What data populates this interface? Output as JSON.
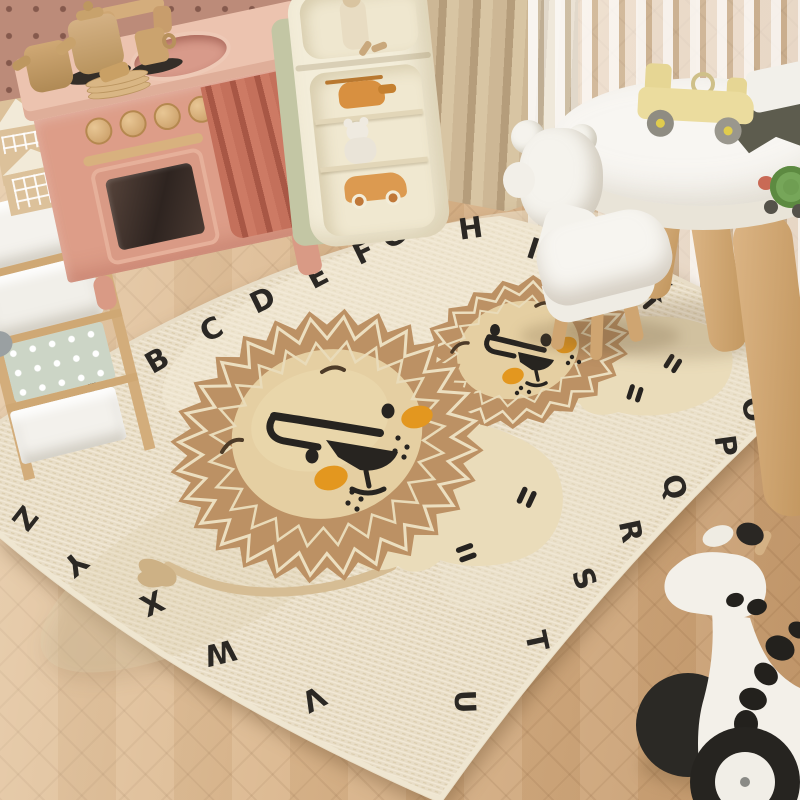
{
  "scene": {
    "setting": "children's playroom with alphabet lion rug"
  },
  "rug": {
    "border_letters": [
      "B",
      "A",
      "B",
      "C",
      "D",
      "E",
      "F",
      "G",
      "H",
      "I",
      "K",
      "N",
      "O",
      "P",
      "Q",
      "R",
      "S",
      "T",
      "U",
      "V",
      "W",
      "X",
      "Y",
      "Z"
    ],
    "base_color": "#e8ddc7",
    "letter_color": "#2b2824",
    "lion_mane_color": "#bc9164",
    "lion_face_color": "#e5cfa2",
    "lion_cheek_color": "#e3971f",
    "lion_body_color": "#eadcba"
  },
  "objects": {
    "play_kitchen": {
      "body_color": "#dd9d88",
      "counter_color": "#ecc3af",
      "curtain_color": "#c4705b",
      "knob_count": 4
    },
    "storage_unit": {
      "bin_colors": [
        "#f4f2ed",
        "#f1efe9",
        "#ccd5c6",
        "#f3f1ec"
      ]
    },
    "toy_houses": {
      "count": 3,
      "color": "#dcc19a"
    },
    "toy_shelf": {
      "front_color": "#f3edd9",
      "side_color": "#c3c6a4",
      "toys": [
        "doll",
        "helicopter",
        "teddy-bear",
        "toy-car"
      ]
    },
    "curtains": {
      "pleated_color": "#c9b492",
      "sheer_color": "#f5f3ee"
    },
    "kids_table": {
      "top_color": "#f8f6f2",
      "leg_color": "#cda46f",
      "toys": [
        "wooden-car",
        "dark-toy",
        "snail"
      ]
    },
    "kids_chair": {
      "body_color": "#f6f4ee",
      "leg_color": "#cfa571"
    },
    "giraffe_toy": {
      "body_color": "#f3f0e9",
      "spot_color": "#23211d"
    },
    "floor": {
      "material": "herringbone-wood",
      "color": "#d3a87c"
    }
  }
}
